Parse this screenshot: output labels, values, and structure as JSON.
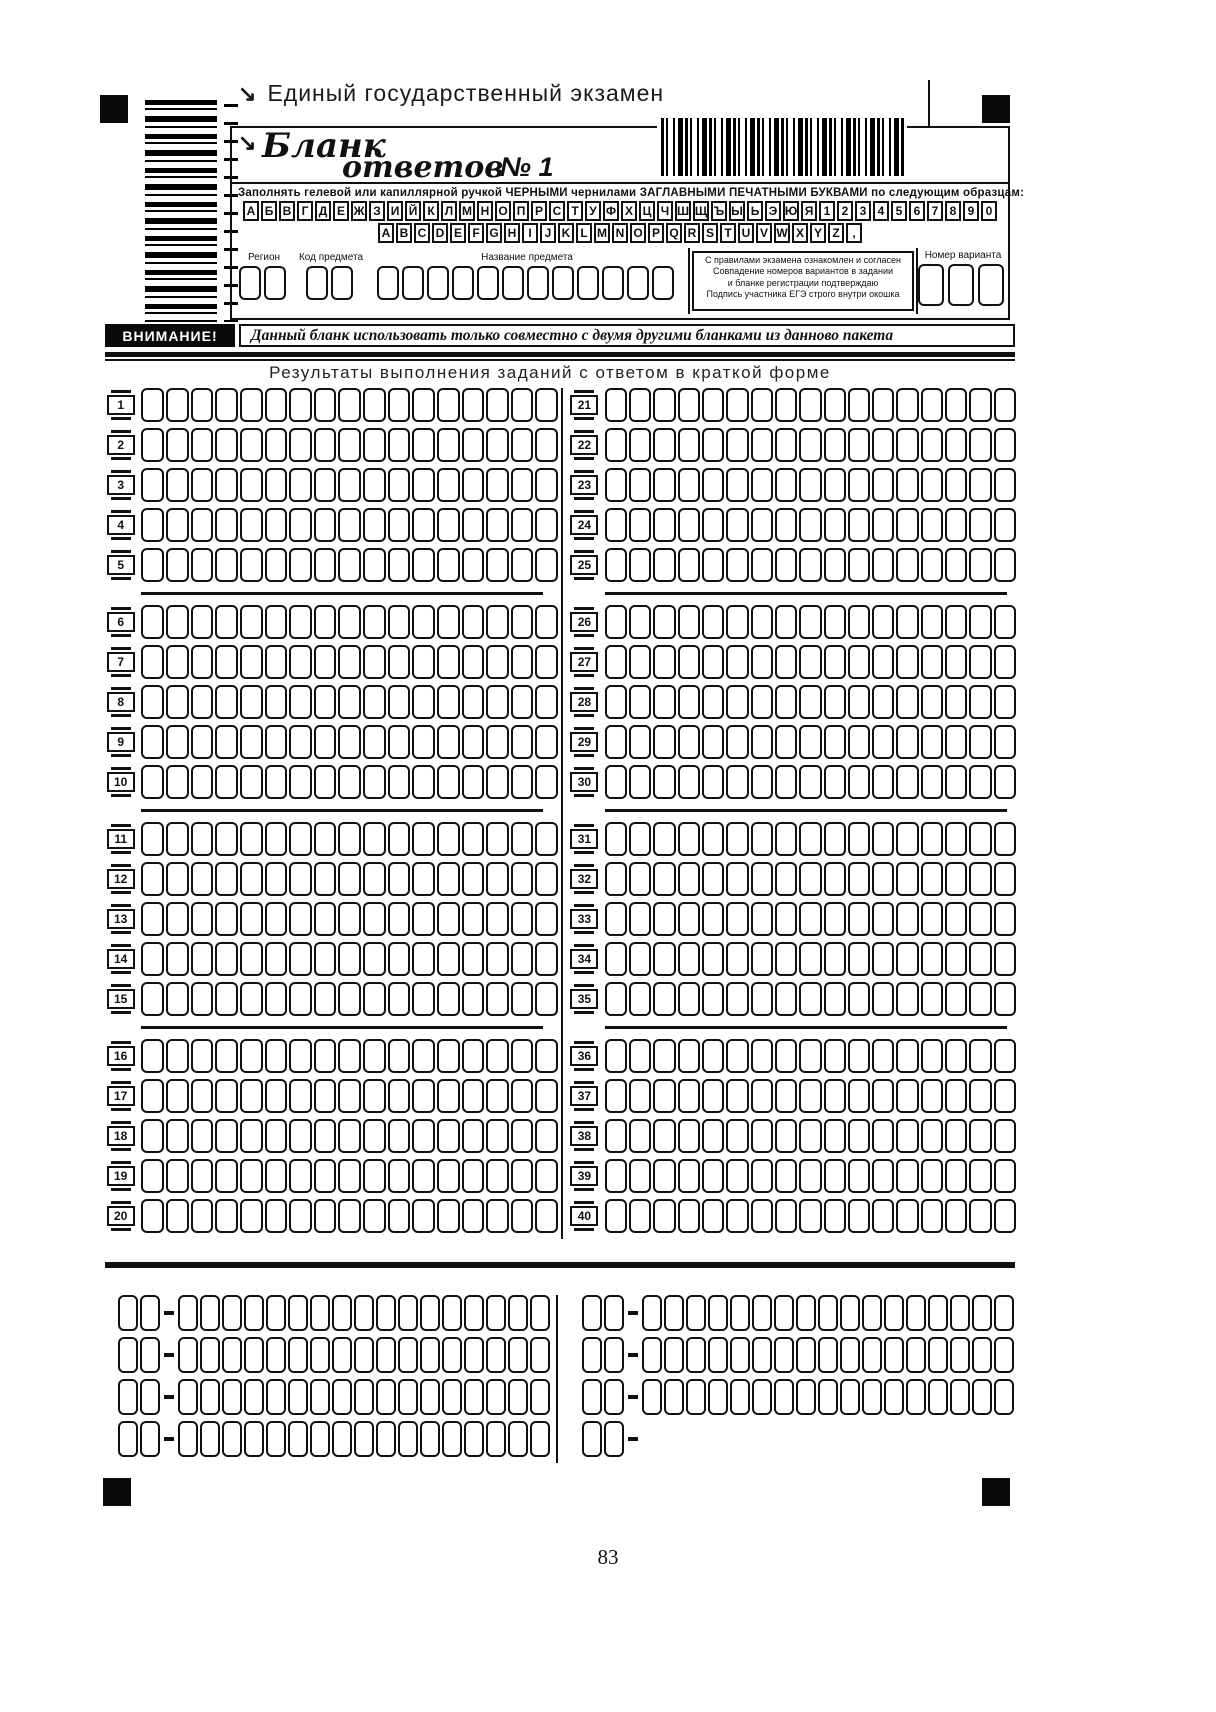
{
  "ink": "#111111",
  "page": {
    "number": "83"
  },
  "header": {
    "corner_mark": "↘",
    "exam_title": "Единый государственный экзамен",
    "form_title": "Бланк",
    "form_subtitle": "ответов",
    "form_number": "№ 1",
    "instruction": "Заполнять гелевой  или капиллярной ручкой ЧЕРНЫМИ чернилами ЗАГЛАВНЫМИ ПЕЧАТНЫМИ БУКВАМИ по следующим образцам:",
    "sample_row1": "АБВГДЕЖЗИЙКЛМНОПРСТУФХЦЧШЩЪЫЬЭЮЯ1234567890",
    "sample_row2": "ABCDEFGHIJKLMNOPQRSTUVWXYZ,"
  },
  "fields": {
    "region": {
      "label": "Регион",
      "cells": 2
    },
    "subject_code": {
      "label": "Код предмета",
      "cells": 2
    },
    "subject_name": {
      "label": "Название предмета",
      "cells": 12
    },
    "agreement": {
      "lines": [
        "С правилами экзамена ознакомлен и согласен",
        "Совпадение номеров вариантов в задании",
        "и бланке регистрации подтверждаю",
        "Подпись участника ЕГЭ строго внутри окошка"
      ]
    },
    "variant": {
      "label": "Номер варианта",
      "cells": 3
    }
  },
  "warning": {
    "label": "ВНИМАНИЕ!",
    "text": "Данный бланк использовать только совместно с двумя другими бланками из данново пакета"
  },
  "answers": {
    "title": "Результаты выполнения заданий с ответом в краткой форме",
    "cells_per_row": 17,
    "rows_per_group": 5,
    "columns": [
      {
        "start": 1,
        "end": 20
      },
      {
        "start": 21,
        "end": 40
      }
    ]
  },
  "corrections": {
    "prefix_cells": 2,
    "answer_cells": 17,
    "columns": [
      {
        "rows": 4,
        "short_last": false
      },
      {
        "rows": 4,
        "short_last": true
      }
    ]
  }
}
